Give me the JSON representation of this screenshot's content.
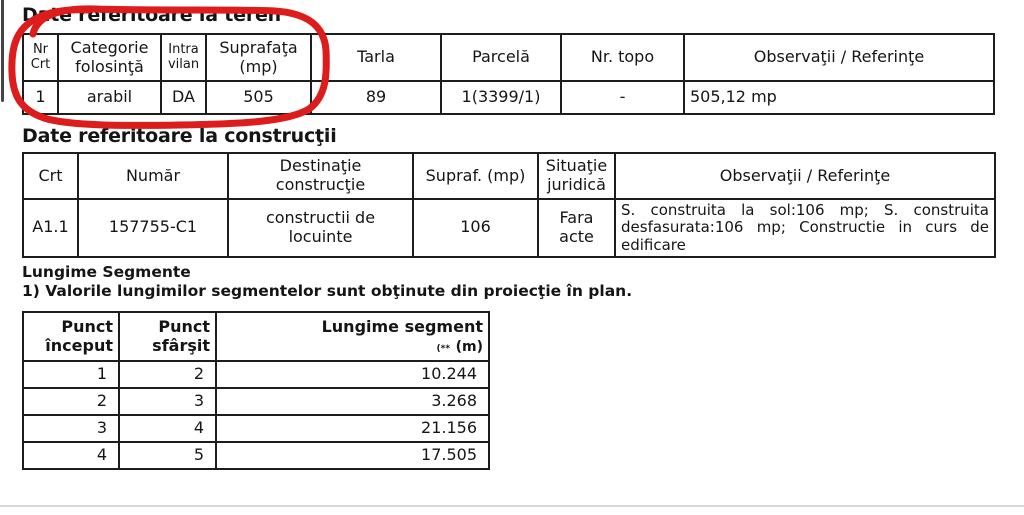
{
  "annotation": {
    "color": "#dd1c1c"
  },
  "teren": {
    "title": "Date referitoare la teren",
    "headers": {
      "nr": "Nr\nCrt",
      "categorie": "Categorie\nfolosinţă",
      "intravilan": "Intra\nvilan",
      "suprafata": "Suprafaţa\n(mp)",
      "tarla": "Tarla",
      "parcela": "Parcelă",
      "nr_topo": "Nr. topo",
      "observatii": "Observaţii / Referinţe"
    },
    "row": {
      "nr": "1",
      "categorie": "arabil",
      "intravilan": "DA",
      "suprafata": "505",
      "tarla": "89",
      "parcela": "1(3399/1)",
      "nr_topo": "-",
      "observatii": "505,12 mp"
    }
  },
  "constructii": {
    "title": "Date referitoare la construcţii",
    "headers": {
      "crt": "Crt",
      "numar": "Număr",
      "destinatie": "Destinaţie\nconstrucţie",
      "supraf": "Supraf. (mp)",
      "situatie": "Situaţie juridică",
      "observatii": "Observaţii / Referinţe"
    },
    "row": {
      "crt": "A1.1",
      "numar": "157755-C1",
      "destinatie": "constructii de\nlocuinte",
      "supraf": "106",
      "situatie": "Fara acte",
      "observatii": "S. construita la sol:106 mp; S. construita desfasurata:106 mp; Constructie in curs de edificare"
    }
  },
  "segmente": {
    "title": "Lungime Segmente",
    "note": "1) Valorile lungimilor segmentelor sunt obţinute din proiecţie în plan.",
    "headers": {
      "start": "Punct\nînceput",
      "end": "Punct\nsfârşit",
      "length": "Lungime segment",
      "unit_marker": "(**",
      "unit": "(m)"
    },
    "rows": [
      {
        "start": "1",
        "end": "2",
        "length": "10.244"
      },
      {
        "start": "2",
        "end": "3",
        "length": "3.268"
      },
      {
        "start": "3",
        "end": "4",
        "length": "21.156"
      },
      {
        "start": "4",
        "end": "5",
        "length": "17.505"
      }
    ]
  }
}
